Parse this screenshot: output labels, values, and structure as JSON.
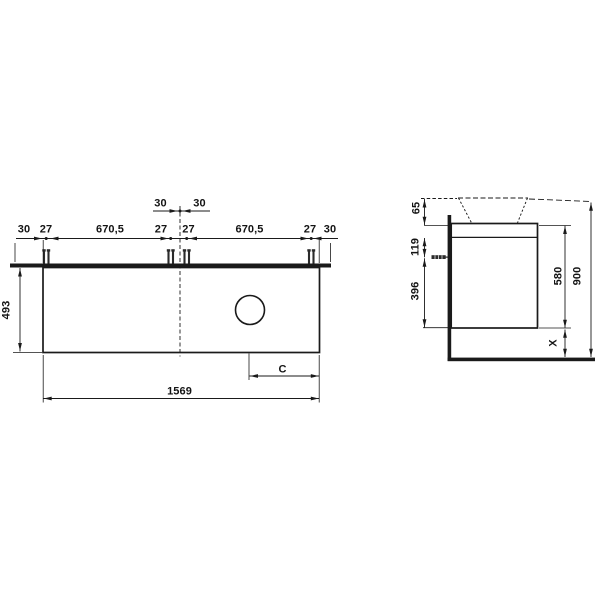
{
  "front_view": {
    "row1": [
      "30",
      "30"
    ],
    "row2": [
      "30",
      "27",
      "670,5",
      "27",
      "27",
      "670,5",
      "27",
      "30"
    ],
    "height": "493",
    "width": "1569",
    "outlet_offset": "C"
  },
  "side_view": {
    "rim_to_top": "65",
    "top_to_fixing": "119",
    "fixing_to_bottom": "396",
    "body_height": "580",
    "overall_height": "900",
    "floor_clearance": "X"
  }
}
